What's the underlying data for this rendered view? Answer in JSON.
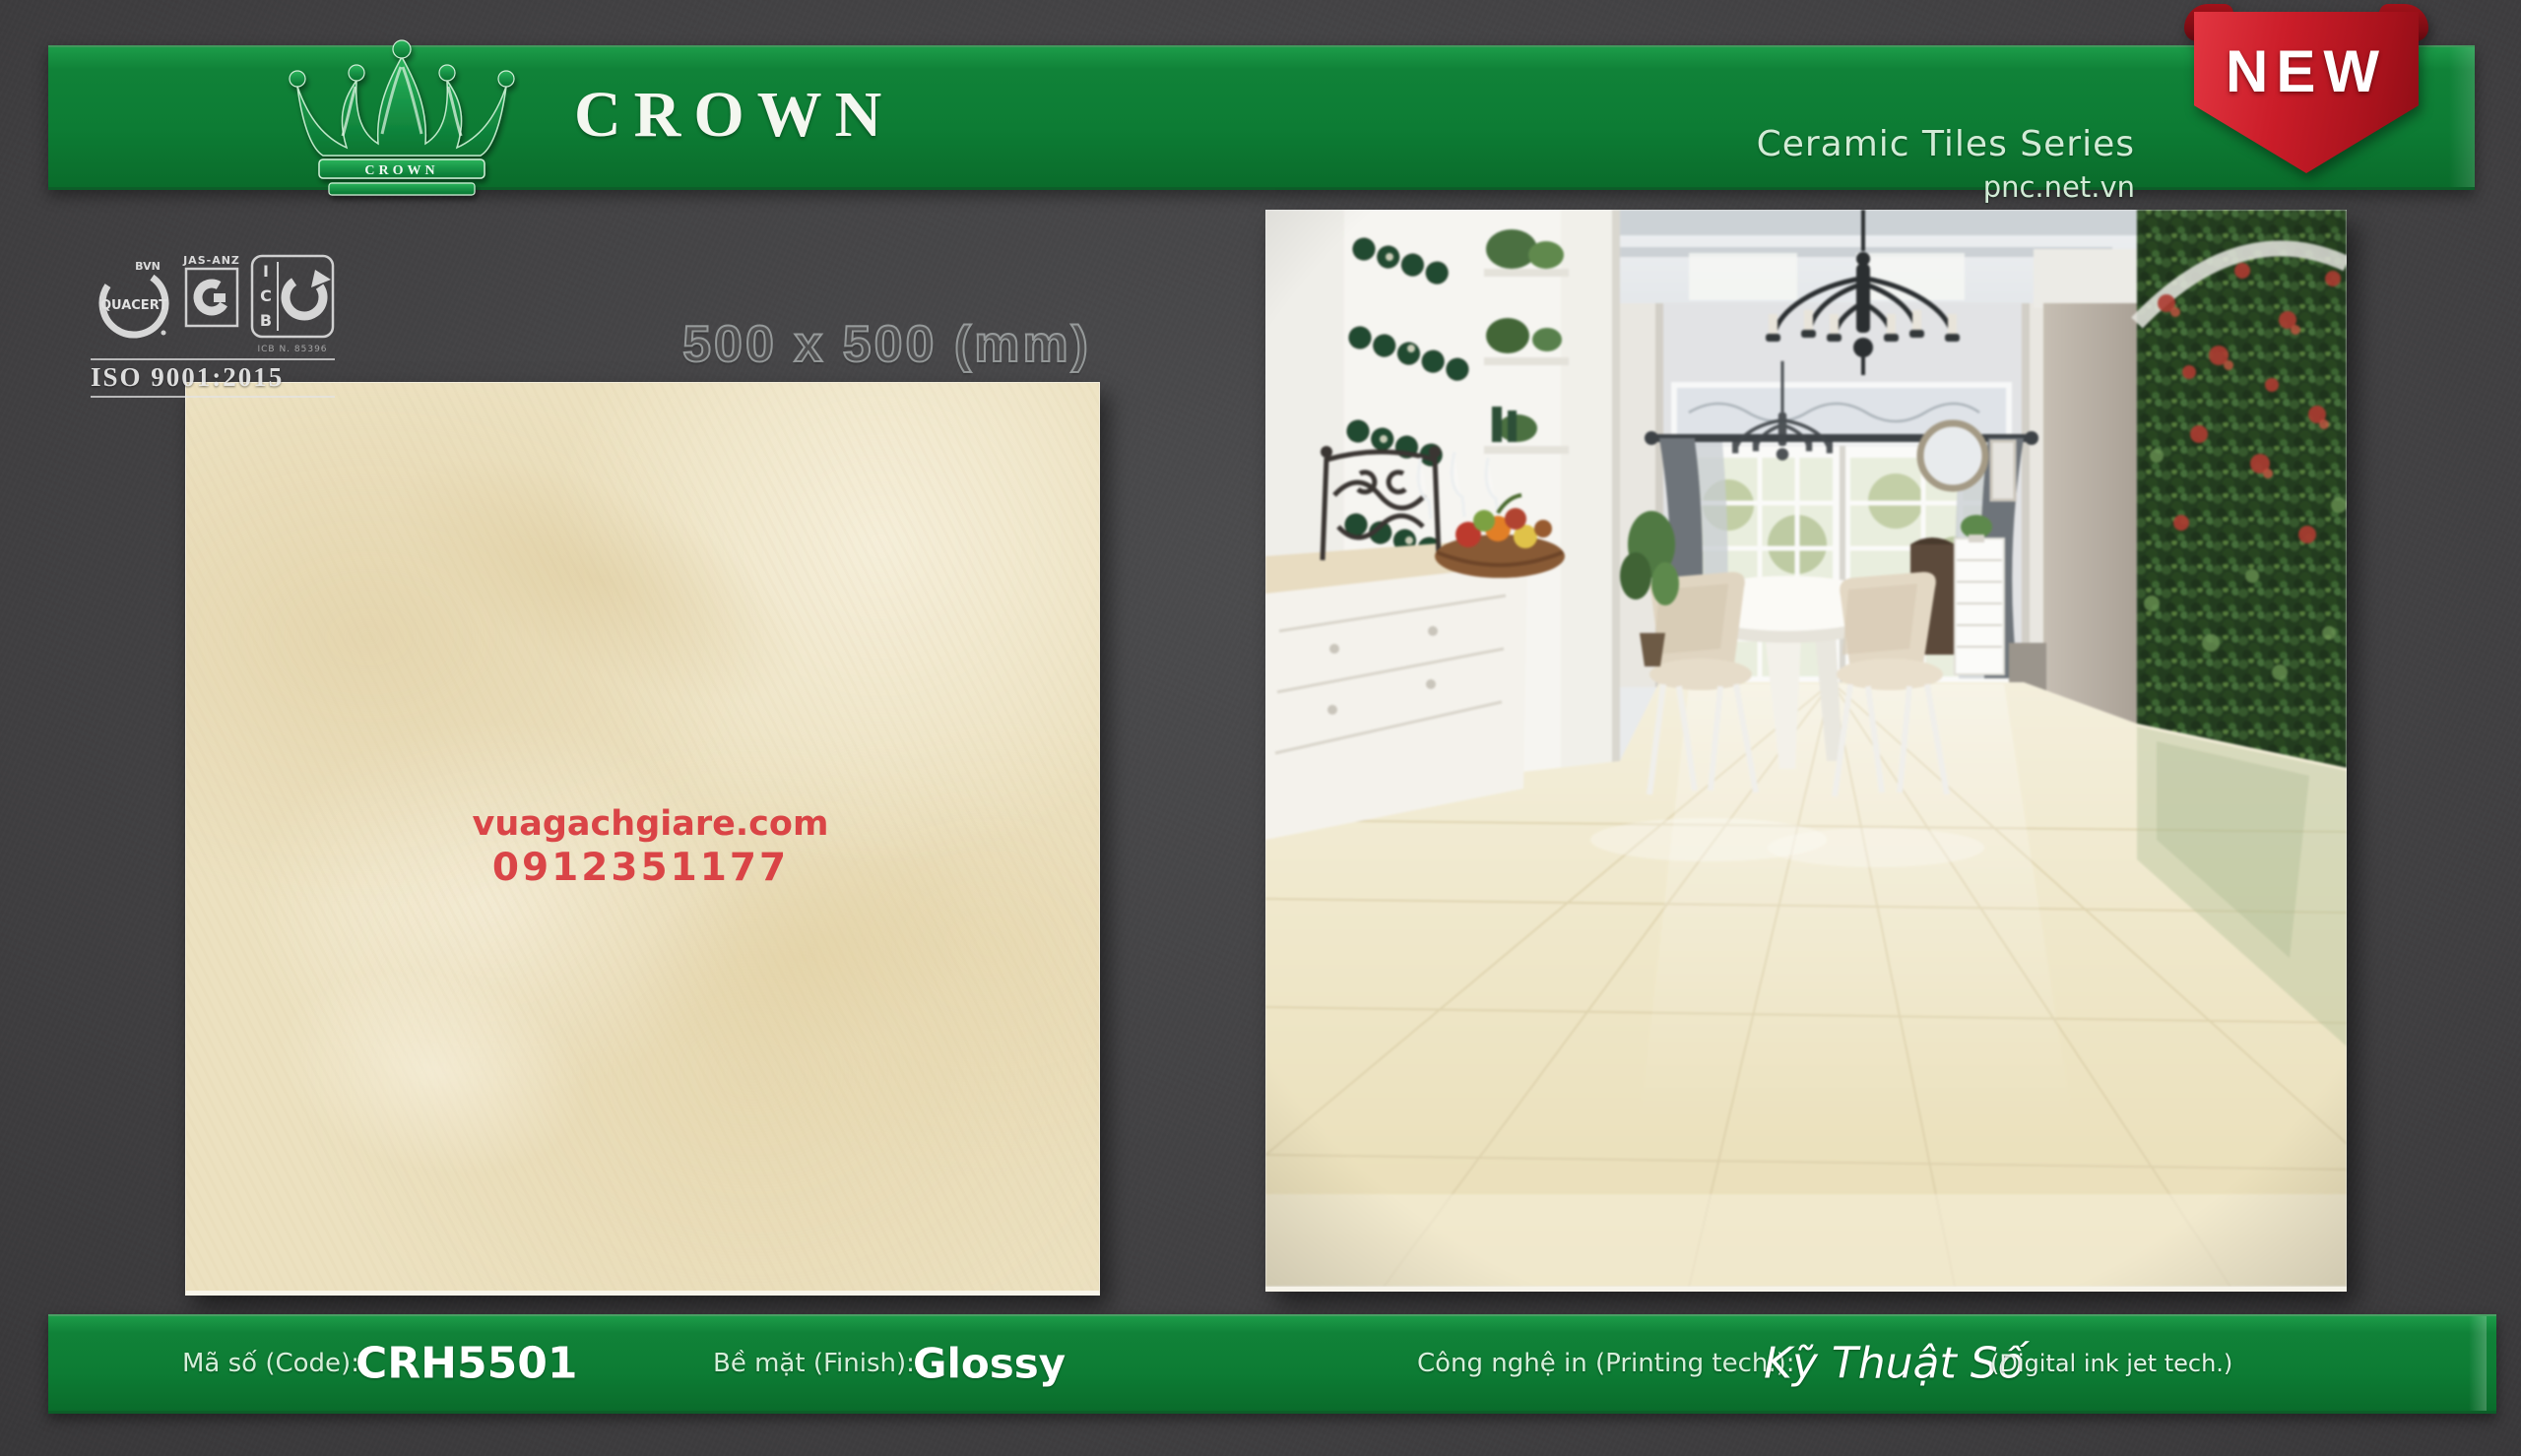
{
  "header": {
    "brand": "CROWN",
    "logo_text": "CROWN",
    "series": "Ceramic Tiles Series",
    "website": "pnc.net.vn",
    "badge": "NEW"
  },
  "certifications": {
    "quacert": "QUACERT",
    "quacert_top": "BVN",
    "jas_anz": "JAS-ANZ",
    "icb": "ICB",
    "icb_note": "ICB N. 85396",
    "iso": "ISO 9001:2015"
  },
  "size_label": "500 x 500 (mm)",
  "tile": {
    "watermark_site": "vuagachgiare.com",
    "watermark_phone": "0912351177"
  },
  "footer": {
    "code_label": "Mã số (Code):",
    "code_value": "CRH5501",
    "finish_label": "Bề mặt (Finish):",
    "finish_value": "Glossy",
    "printing_label": "Công nghệ in (Printing tech.):",
    "printing_value": "Kỹ Thuật Số",
    "printing_note": "(Digital ink jet tech.)"
  },
  "colors": {
    "bar_green": "#0d7c34",
    "ribbon_red": "#c21a26",
    "tile_beige": "#ece1c0",
    "watermark_red": "#d8363c",
    "background": "#3e3e40"
  }
}
